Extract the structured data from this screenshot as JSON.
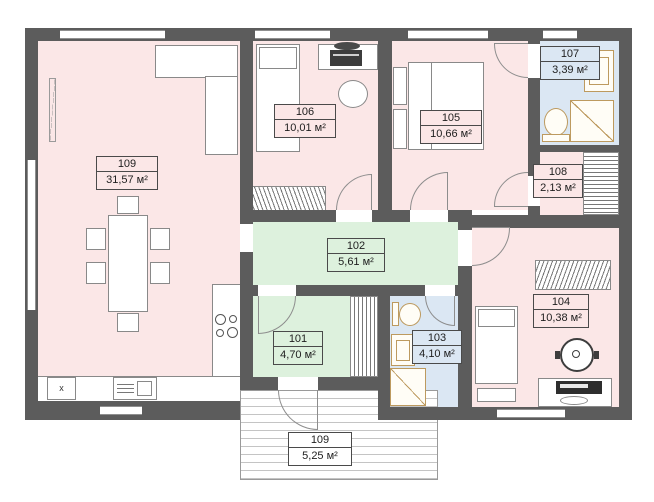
{
  "floor_plan": {
    "rooms": [
      {
        "number": "101",
        "area": "4,70 м²",
        "fill": "#ddf1dd"
      },
      {
        "number": "102",
        "area": "5,61 м²",
        "fill": "#ddf1dd"
      },
      {
        "number": "103",
        "area": "4,10 м²",
        "fill": "#dbe7f3"
      },
      {
        "number": "104",
        "area": "10,38 м²",
        "fill": "#fbe7e7"
      },
      {
        "number": "105",
        "area": "10,66 м²",
        "fill": "#fbe7e7"
      },
      {
        "number": "106",
        "area": "10,01 м²",
        "fill": "#fbe7e7"
      },
      {
        "number": "107",
        "area": "3,39 м²",
        "fill": "#dbe7f3"
      },
      {
        "number": "108",
        "area": "2,13 м²",
        "fill": "#fbe7e7"
      },
      {
        "number": "109",
        "area": "31,57 м²",
        "fill": "#fbe7e7"
      }
    ],
    "terrace": {
      "number": "109",
      "area": "5,25 м²"
    },
    "kitchen": {
      "appliance_label": "x"
    },
    "colors": {
      "wall": "#5c5c5c",
      "pink": "#fbe7e7",
      "green": "#ddf1dd",
      "blue": "#dbe7f3",
      "fixture": "#bd9a5f"
    }
  }
}
